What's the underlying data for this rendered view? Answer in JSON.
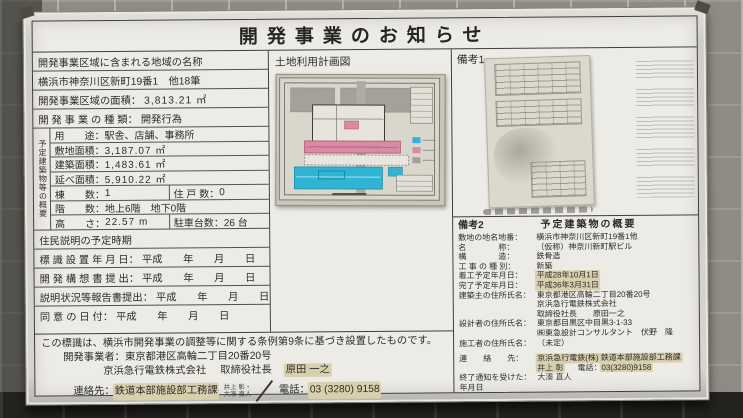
{
  "title": "開発事業のお知らせ",
  "left": {
    "row1": "開発事業区域に含まれる地域の名称",
    "row2": "横浜市神奈川区新町19番1　他18筆",
    "row3_label": "開発事業区域の面積：",
    "row3_value": "3,813.21 ㎡",
    "row4_label": "開 発 事 業 の 種 類：",
    "row4_value": "開発行為",
    "building": {
      "vertical_label": "予定建築物等の概要",
      "use_label": "用　　途：",
      "use_value": "駅舎、店舗、事務所",
      "site_label": "敷地面積：",
      "site_value": "3,187.07 ㎡",
      "bldg_label": "建築面積：",
      "bldg_value": "1,483.61 ㎡",
      "floor_label": "延べ面積：",
      "floor_value": "5,910.22 ㎡",
      "count_label": "棟　　数：",
      "count_value": "1",
      "units_label": "住 戸 数：",
      "units_value": "0",
      "stories_label": "階　　数：",
      "stories_value": "地上6階　地下0階",
      "height_label": "高　　さ：",
      "height_value": "22.57 m",
      "parking_label": "駐車台数：",
      "parking_value": "26 台"
    },
    "schedule_header": "住民説明の予定時期",
    "sch1_label": "標 識 設 置 年 月 日：",
    "sch1_value": "平成　　年　　月　　日",
    "sch2_label": "開 発 構 想 書 提 出：",
    "sch2_value": "平成　　年　　月　　日",
    "sch3_label": "説明状況等報告書提出：",
    "sch3_value": "平成　　年　　月　　日",
    "sch4_label": "同 意 の 日 付：",
    "sch4_value": "平成　　年　　月　　日"
  },
  "map_section": {
    "header": "土地利用計画図"
  },
  "remarks1": {
    "header": "備考1"
  },
  "remarks2": {
    "header_label": "備考2",
    "header_title": "予定建築物の概要",
    "lot_label": "敷地の地名地番：",
    "lot_value": "横浜市神奈川区新町19番1他",
    "name_label": "名　　　　称：",
    "name_value": "（仮称）神奈川新町駅ビル",
    "structure_label": "構　　　　造：",
    "structure_value": "鉄骨造",
    "worktype_label": "工 事 の 種 別：",
    "worktype_value": "新築",
    "start_label": "着工予定年月日：",
    "start_value": "平成28年10月1日",
    "end_label": "完了予定年月日：",
    "end_value": "平成36年3月31日",
    "owner_label": "建築主の住所氏名：",
    "owner_value1": "東京都港区高輪二丁目20番20号",
    "owner_value2": "京浜急行電鉄株式会社",
    "owner_value3": "取締役社長　　原田一之",
    "designer_label": "設計者の住所氏名：",
    "designer_value1": "東京都目黒区中目黒3-1-33",
    "designer_value2": "㈱東急設計コンサルタント　伏野　隆",
    "builder_label": "施工者の住所氏名：",
    "builder_value": "（未定）",
    "contact_label": "連　　絡　　先：",
    "contact_value1": "京浜急行電鉄(株) 鉄道本部施設部工務課",
    "contact_value2": "井上 彰",
    "contact_phone_label": "電話：",
    "contact_phone": "03(3280)9158",
    "notice_label": "終了通知を受けた：",
    "notice_value": "大湊 直人",
    "notice_label2": "年月日"
  },
  "footer": {
    "line1": "この標識は、横浜市開発事業の調整等に関する条例第9条に基づき設置したものです。",
    "line2_label": "開発事業者：",
    "line2_value": "東京都港区高輪二丁目20番20号",
    "line3_company": "京浜急行電鉄株式会社",
    "line3_title": "取締役社長",
    "line3_name": "原田 一之",
    "line4_label": "連絡先：",
    "line4_dept": "鉄道本部施設部工務課",
    "line4_hand1": "井上 彰・",
    "line4_hand2": "大湊 直人",
    "line4_phone_label": "電話：",
    "line4_phone": "03 (3280) 9158"
  },
  "colors": {
    "board": "#edebe6",
    "tape": "#d8cfad",
    "map_cyan": "#2fb5d3",
    "map_pink": "#d88ba4",
    "wall": "#8d8b83"
  }
}
